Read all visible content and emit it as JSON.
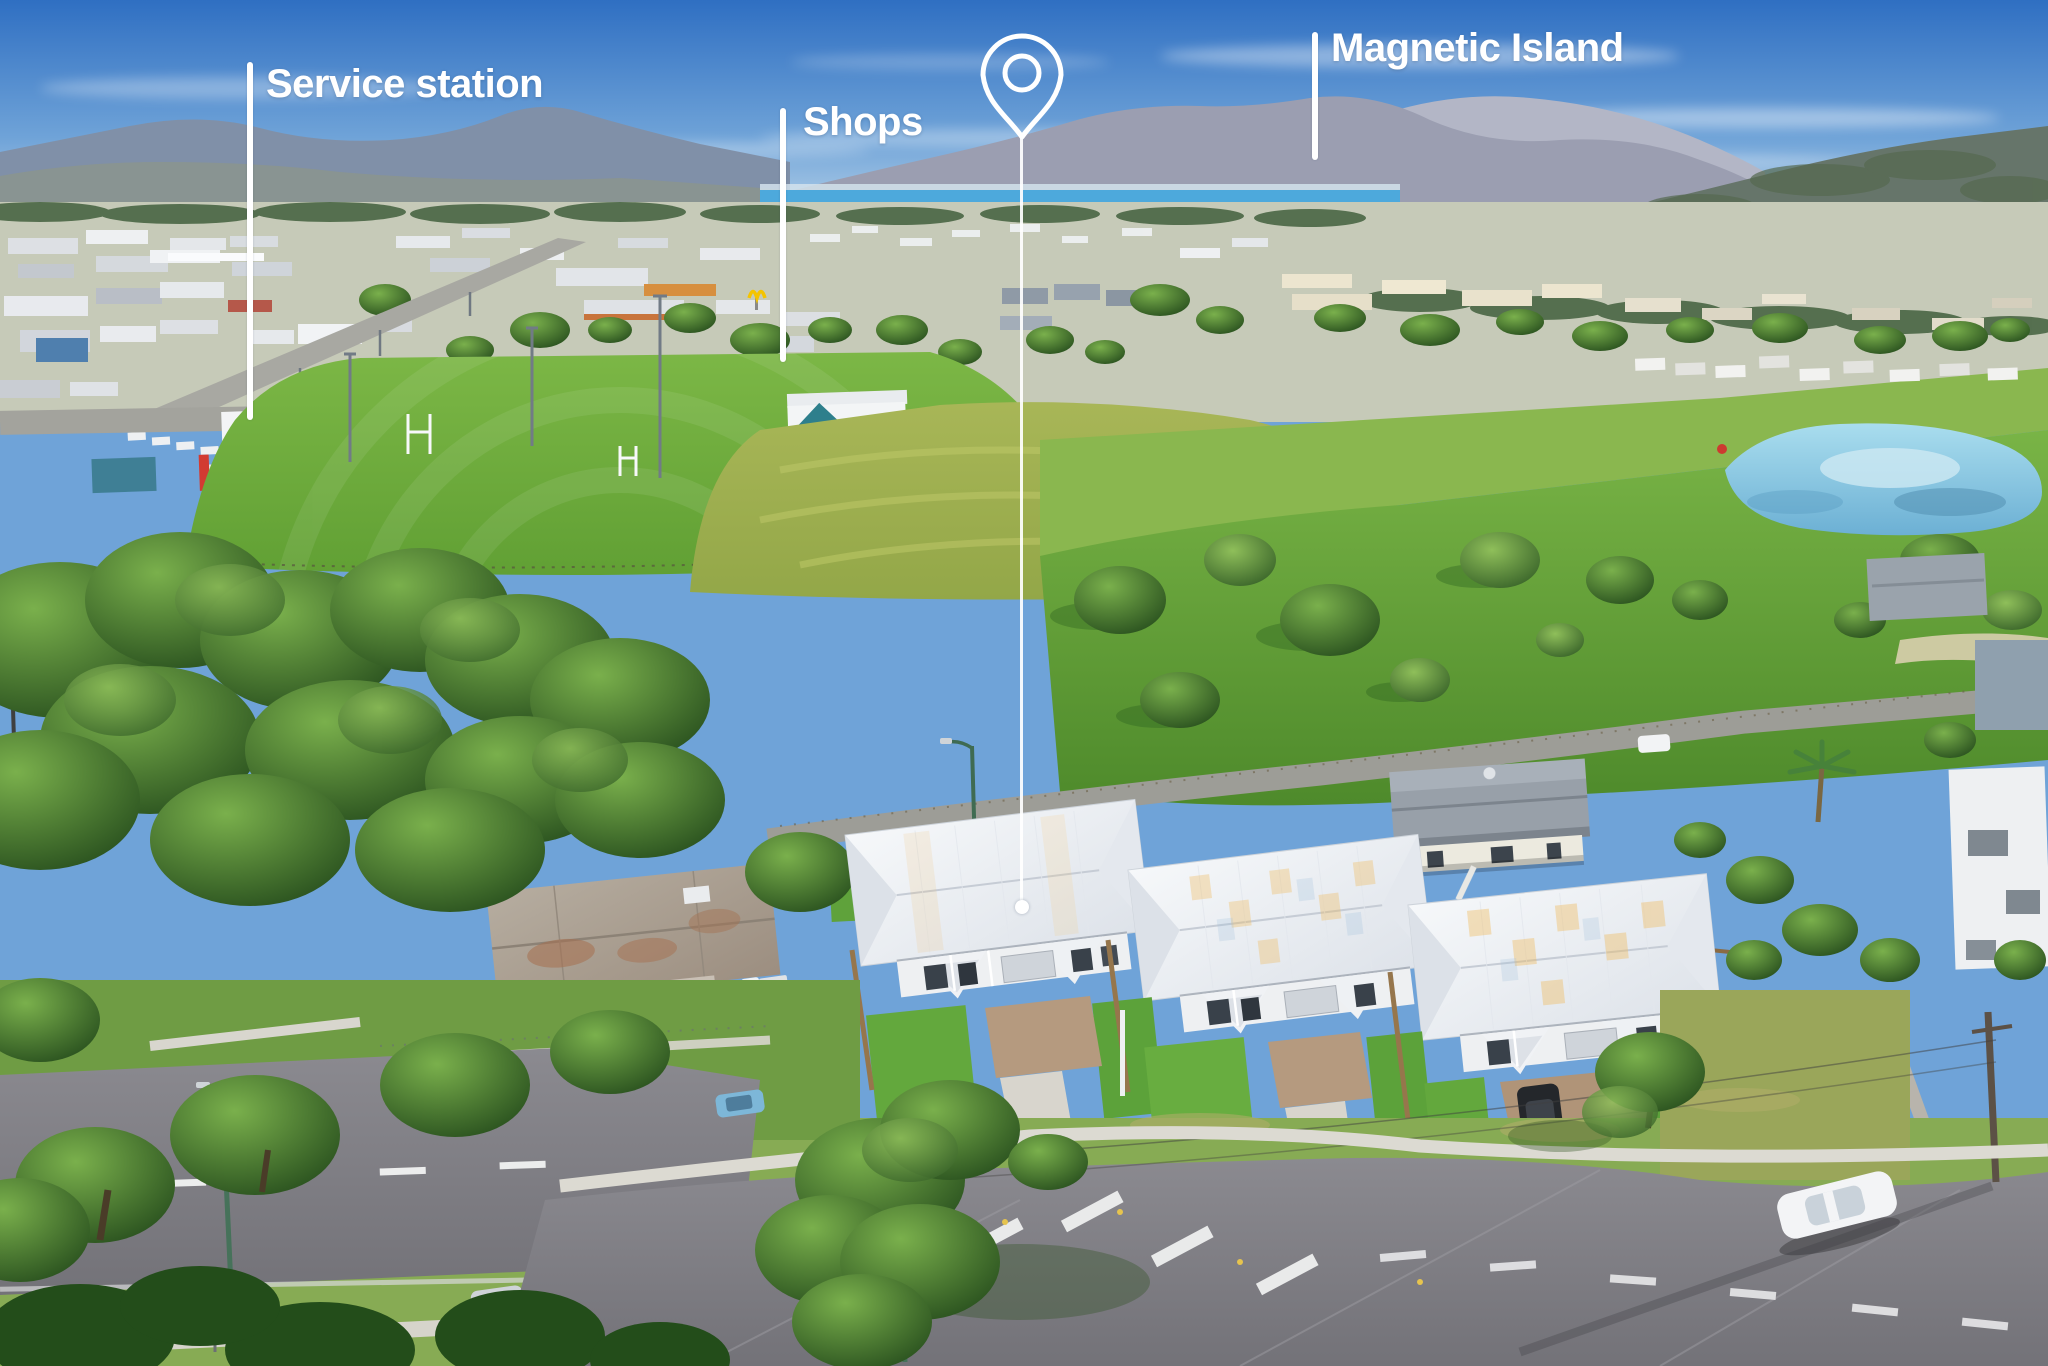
{
  "annotations": {
    "service_station": {
      "label": "Service station"
    },
    "shops": {
      "label": "Shops"
    },
    "magnetic_island": {
      "label": "Magnetic Island"
    },
    "property_marker": {
      "icon": "location-pin-icon"
    }
  },
  "colors": {
    "annotation_white": "#ffffff",
    "sky_top": "#3c78c4",
    "sky_horizon": "#cfe2ef",
    "sea": "#4da9dc",
    "mountain_haze": "#9b9eb1",
    "field_green": "#74b13f",
    "meadow_green": "#9db04f",
    "parkland_green": "#5f9c33",
    "tree_dark_green": "#2e5a22",
    "roof_white": "#eef1f5",
    "roof_glint": "#f2b95c",
    "road_asphalt": "#7e7d82",
    "concrete": "#dbd9d2",
    "pond_blue": "#8fd2ea",
    "fence_timber": "#8a6b44",
    "service_station_red": "#d23b32"
  }
}
